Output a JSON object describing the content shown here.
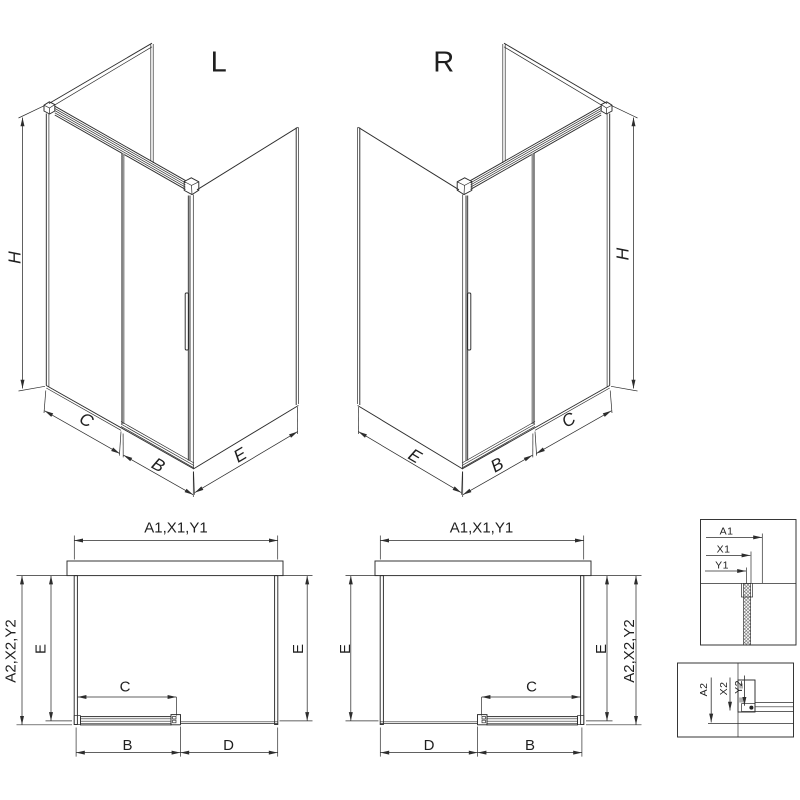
{
  "drawing": {
    "iso_left": {
      "label": "L",
      "h": "H",
      "c": "C",
      "b": "B",
      "e": "E"
    },
    "iso_right": {
      "label": "R",
      "h": "H",
      "c": "C",
      "b": "B",
      "e": "E"
    },
    "plan_left": {
      "top": "A1,X1,Y1",
      "side": "A2,X2,Y2",
      "e_left": "E",
      "e_right": "E",
      "c": "C",
      "b": "B",
      "d": "D"
    },
    "plan_right": {
      "top": "A1,X1,Y1",
      "side": "A2,X2,Y2",
      "e_left": "E",
      "e_right": "E",
      "c": "C",
      "d": "D",
      "b": "B"
    },
    "detail_top": {
      "a1": "A1",
      "x1": "X1",
      "y1": "Y1"
    },
    "detail_bottom": {
      "a2": "A2",
      "x2": "X2",
      "y2": "Y2"
    }
  },
  "colors": {
    "line": "#2d2d2d",
    "glass_edge": "#949494",
    "handle_fill": "#ececec"
  }
}
